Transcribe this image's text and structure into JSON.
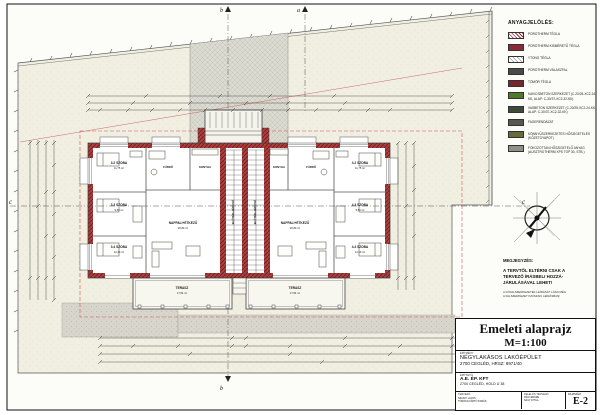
{
  "sheet": {
    "title": "Emeleti alaprajz",
    "scale": "M=1:100",
    "drawing_number": "E-2"
  },
  "title_block": {
    "project_label": "ÉPÍTMÉNY:",
    "project_name": "NÉGYLAKÁSOS LAKÓÉPÜLET",
    "project_address": "2700 CEGLÉD, HRSZ: 8971/40",
    "client_label": "ÉPÍTTETŐ:",
    "client_name": "A.E. ÉP. KFT",
    "client_address": "2700 CEGLÉD, HOLD U 38",
    "designer_label": "TERVEZŐ:",
    "designer_1": "SZANYI LAJOS",
    "designer_2": "TÖRÖKGYÁRTÓ TAMÁS",
    "checker_label": "FELELŐS TERVEZŐ:",
    "checker_1": "PÁLFI ENDRE",
    "checker_2": "NAGY ATTILA",
    "number_label": "RAJZSZÁM:",
    "number": "E-2"
  },
  "legend": {
    "title": "ANYAGJELÖLÉS:",
    "items": [
      {
        "label": "POROTHERM TÉGLA",
        "swatch": "#a03038"
      },
      {
        "label": "POROTHERM KISMÉRETŰ TÉGLA",
        "swatch": "#8b2a35"
      },
      {
        "label": "YTONG TÉGLA",
        "swatch": "#ffffff"
      },
      {
        "label": "POROTHERM VÁLASZFAL",
        "swatch": "#4a4a4a"
      },
      {
        "label": "TÖMÖR TÉGLA",
        "swatch": "#7a2430"
      },
      {
        "label": "KAVICSBETON SZERKEZET (C-20/25-XC2-24-KK, ALAP: C-30/37-XC2-32-KK)",
        "swatch": "#4c7a2a"
      },
      {
        "label": "VASBETON SZERKEZET (C-20/25-XC2-24-KK, ALAP: C-30/37-XC2-32-KK)",
        "swatch": "#3f4a3c"
      },
      {
        "label": "FAGERENDÁZAT",
        "swatch": "#55594f"
      },
      {
        "label": "KÖNNYŰSZERKEZETES HŐSZIGETELÉS (KŐZETGYAPOT)",
        "swatch": "#6b6b3a"
      },
      {
        "label": "FOKOZOTTAN HŐSZIGETELŐ ANYAG (AUSZTROTHERM XPS TOP 30, STB.)",
        "swatch": "#8f9086"
      }
    ]
  },
  "notes": {
    "heading": "MEGJEGYZÉS:",
    "line1": "A TERVTŐL ELTÉRNI CSAK A",
    "line2": "TERVEZŐ ÍRÁSBELI HOZZÁ-",
    "line3": "JÁRULÁSÁVAL LEHET!",
    "small1": "A FŐFALSZERKEZETEK LEÍRÁSÁT LÁSD MÉG",
    "small2": "A FALSZERKEZETI MŰSZAKI LEÍRÁSBAN!"
  },
  "plan": {
    "left_rooms": [
      {
        "title": "3.2 SZOBA",
        "area": "11,75 m²"
      },
      {
        "title": "3.3 SZOBA",
        "area": "9,50 m²"
      },
      {
        "title": "3.4 SZOBA",
        "area": "12,10 m²"
      }
    ],
    "right_rooms": [
      {
        "title": "4.2 SZOBA",
        "area": "11,75 m²"
      },
      {
        "title": "4.3 SZOBA",
        "area": "9,50 m²"
      },
      {
        "title": "4.4 SZOBA",
        "area": "12,10 m²"
      }
    ],
    "left_bath": "FÜRDŐ",
    "left_kitchen": "KONYHA",
    "right_kitchen": "KONYHA",
    "right_bath": "FÜRDŐ",
    "left_living": {
      "title": "NAPPALI+ÉTKEZŐ",
      "area": "26,80 m²"
    },
    "right_living": {
      "title": "NAPPALI+ÉTKEZŐ",
      "area": "26,80 m²"
    },
    "stair": "ELŐTÉR+LÉPCSŐ",
    "terrace_left": {
      "title": "TERASZ",
      "area": "17,54 m²"
    },
    "terrace_right": {
      "title": "TERASZ",
      "area": "17,54 m²"
    },
    "sections": {
      "c": "c",
      "a": "a",
      "b": "b"
    }
  },
  "colors": {
    "wall_red": "#a84040",
    "wall_red_dark": "#7c1f1f",
    "site_fill": "#f1efe2",
    "paving_gray": "#dcdcd4",
    "roof_outline_red": "#cc5555",
    "line": "#333333"
  }
}
